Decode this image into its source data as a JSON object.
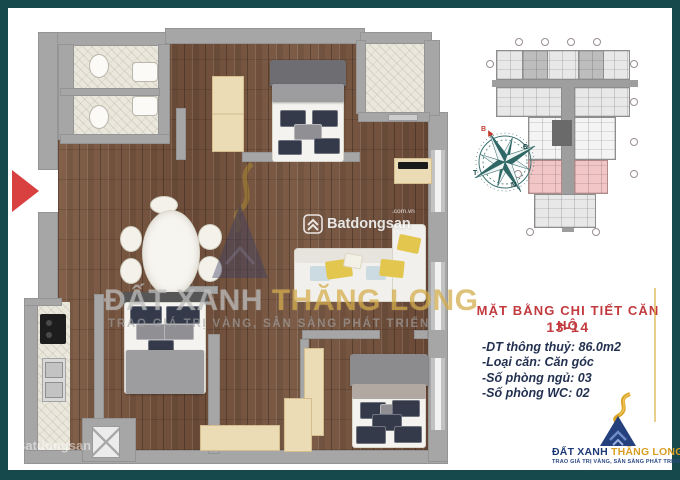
{
  "colors": {
    "frame_teal": "#15494b",
    "title_red": "#c23a3e",
    "details_navy": "#233150",
    "logo_navy": "#1d3a75",
    "logo_gold": "#d89f24",
    "highlight_pink": "#f2c6c6",
    "entrance_red": "#d94040"
  },
  "info_panel": {
    "title": "MẶT BẰNG CHI TIẾT CĂN HỘ",
    "unit_number": "13-14",
    "details": [
      "-DT thông thuỷ: 86.0m2",
      "-Loại căn: Căn góc",
      "-Số phòng ngủ: 03",
      "-Số phòng WC: 02"
    ]
  },
  "logo": {
    "brand_primary": "ĐẤT XANH",
    "brand_secondary": "THĂNG LONG",
    "tagline": "TRAO GIÁ TRỊ VÀNG, SẴN SÀNG PHÁT TRIỂN"
  },
  "watermarks": {
    "center_brand": "Batdongsan",
    "center_suffix": ".com.vn",
    "corner_brand": "Batdongsan",
    "big_part1": "ĐẤT XANH ",
    "big_part2": "THĂNG LONG",
    "big_tagline": "TRAO GIÁ TRỊ VÀNG, SẴN SÀNG PHÁT TRIỂN"
  },
  "compass": {
    "north": "B",
    "east": "Đ",
    "south": "N",
    "west": "T"
  }
}
